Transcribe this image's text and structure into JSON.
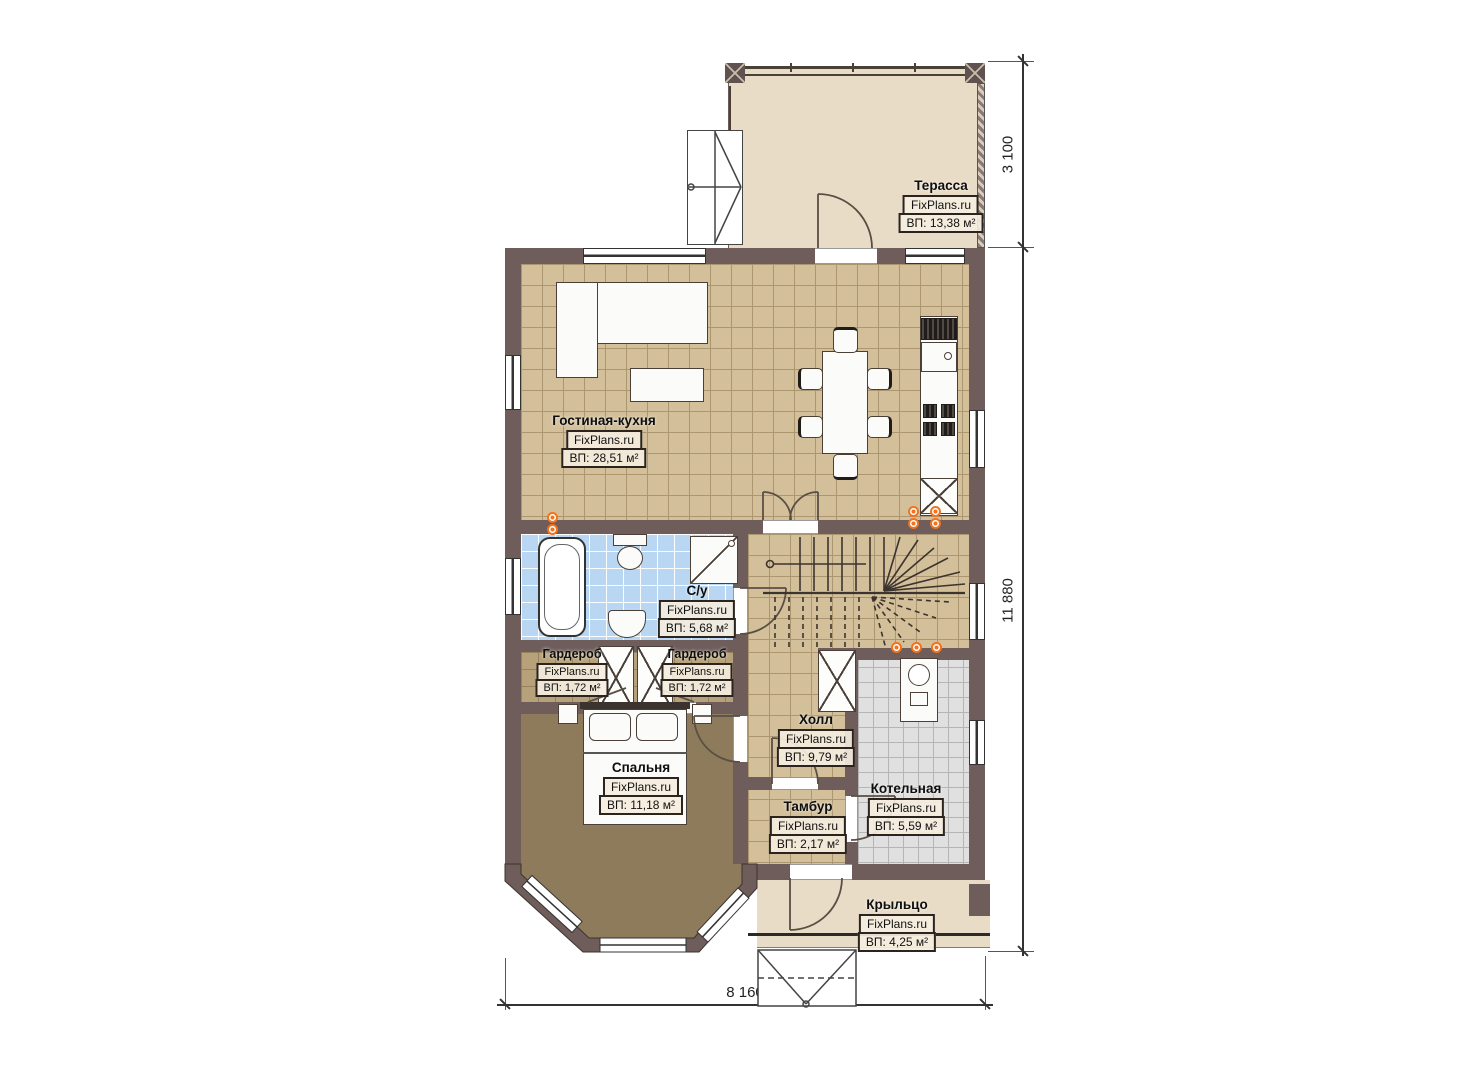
{
  "watermark": "FixPlans.ru",
  "rooms": {
    "terrace": {
      "name": "Терасса",
      "area": "ВП: 13,38 м²"
    },
    "living_kitchen": {
      "name": "Гостиная-кухня",
      "area": "ВП: 28,51 м²"
    },
    "bathroom": {
      "name": "С/у",
      "area": "ВП: 5,68 м²"
    },
    "wardrobe_left": {
      "name": "Гардероб",
      "area": "ВП: 1,72 м²"
    },
    "wardrobe_right": {
      "name": "Гардероб",
      "area": "ВП: 1,72 м²"
    },
    "bedroom": {
      "name": "Спальня",
      "area": "ВП: 11,18 м²"
    },
    "hall": {
      "name": "Холл",
      "area": "ВП: 9,79 м²"
    },
    "vestibule": {
      "name": "Тамбур",
      "area": "ВП: 2,17 м²"
    },
    "boiler_room": {
      "name": "Котельная",
      "area": "ВП: 5,59 м²"
    },
    "porch": {
      "name": "Крыльцо",
      "area": "ВП: 4,25 м²"
    }
  },
  "dimensions": {
    "terrace_depth": "3 100",
    "house_depth": "11 880",
    "house_width": "8 160"
  },
  "colors": {
    "wall": "#6e5d5b",
    "floor_living": "#d3bf99",
    "floor_bedroom": "#8d7b5c",
    "floor_bathroom": "#b9d7f2",
    "floor_boiler": "#e0e0e0",
    "floor_terrace": "#e9dcc6",
    "radiator_accent": "#f2731f"
  }
}
